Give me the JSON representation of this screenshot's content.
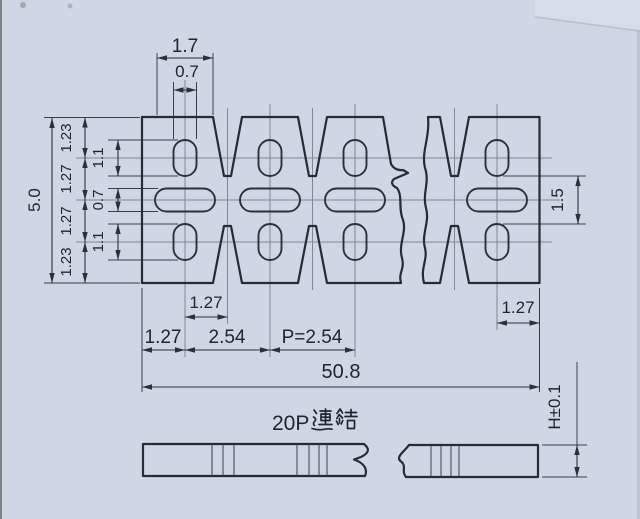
{
  "drawing": {
    "top": {
      "tab_width": "1.7",
      "hole_width": "0.7"
    },
    "left": {
      "overall_height": "5.0",
      "segments": [
        "1.23",
        "1.27",
        "1.27",
        "1.23"
      ],
      "features": [
        "1.1",
        "0.7",
        "1.1"
      ]
    },
    "right": {
      "web_height": "1.5",
      "end_margin": "1.27"
    },
    "bottom": {
      "notch_offset": "1.27",
      "edge_margin": "1.27",
      "span": "2.54",
      "pitch": "P=2.54",
      "overall_width": "50.8"
    },
    "side": {
      "label": "20P連結",
      "label_prefix": "20P",
      "height_tolerance": "H±0.1"
    },
    "colors": {
      "background": "#cdd8e4",
      "line": "#262c35",
      "centerline": "#7b8590"
    }
  }
}
